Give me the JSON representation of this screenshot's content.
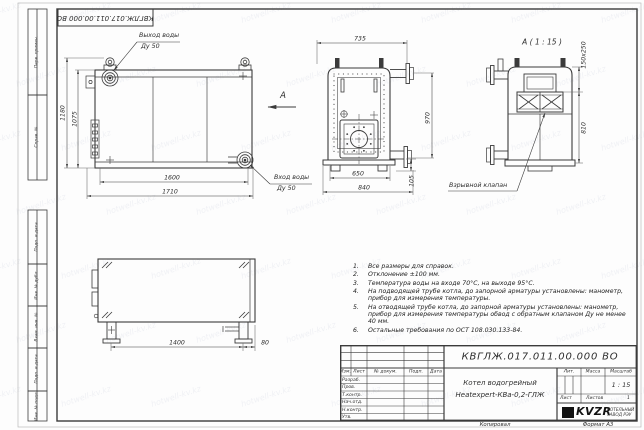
{
  "stamp_doc_number": "КВГЛЖ.017.011.00.000 ВО",
  "frame_stamps": [
    "Перв. примен.",
    "Справ. №",
    "Подп. и дата",
    "Инв. № дубл.",
    "Взам. инв. №",
    "Подп. и дата",
    "Инв. № подл."
  ],
  "labels": {
    "outlet_line1": "Выход воды",
    "outlet_line2": "Ду 50",
    "inlet_line1": "Вход воды",
    "inlet_line2": "Ду 50",
    "view_mark": "А",
    "section_title": "А ( 1 : 15 )",
    "explosion_valve": "Взрывной клапан",
    "watermark": "hotwell-kv.kz"
  },
  "dims": {
    "front": {
      "height_outer": "1180",
      "height_inner": "1075",
      "width_inner": "1600",
      "width_outer": "1710"
    },
    "plan": {
      "width_top": "735",
      "height_right": "970",
      "width_inner": "650",
      "width_outer": "840",
      "pipe_offset": "105"
    },
    "section": {
      "valve_size": "150x250",
      "height": "810"
    },
    "side": {
      "length": "1400",
      "offset": "80"
    }
  },
  "notes": {
    "items": [
      {
        "num": "1.",
        "text": "Все размеры для справок."
      },
      {
        "num": "2.",
        "text": "Отклонение ±100 мм."
      },
      {
        "num": "3.",
        "text": "Температура воды на входе 70°С, на выходе 95°С."
      },
      {
        "num": "4.",
        "text": "На подводящей трубе котла, до запорной арматуры установлены: манометр, прибор для измерения температуры."
      },
      {
        "num": "5.",
        "text": "На отводящей трубе котла, до запорной арматуры установлены: манометр, прибор для измерения температуры  обвод с обратным клапаном Ду не менее 40 мм."
      },
      {
        "num": "6.",
        "text": "Остальные требования по ОСТ 108.030.133-84."
      }
    ]
  },
  "title_block": {
    "doc_number": "КВГЛЖ.017.011.00.000 ВО",
    "name_line1": "Котел водогрейный",
    "name_line2": "Heatexpert-КВа-0,2-ГЛЖ",
    "header_cols": [
      "Изм.",
      "Лист",
      "№ докум.",
      "Подп.",
      "Дата"
    ],
    "sign_rows": [
      "Разраб.",
      "Пров.",
      "Т.контр.",
      "Нач.отд.",
      "Н.контр.",
      "Утв."
    ],
    "lit_label": "Лит.",
    "mass_label": "Масса",
    "scale_label": "Масштаб",
    "scale_value": "1 : 15",
    "sheet_label": "Лист",
    "sheets_label": "Листов",
    "sheets_value": "1",
    "logo_text": "KVZR",
    "company_line1": "КОТЕЛЬНЫЙ",
    "company_line2": "ЗАВОД РЭУ",
    "kopiroval": "Копировал",
    "format": "Формат А3"
  }
}
